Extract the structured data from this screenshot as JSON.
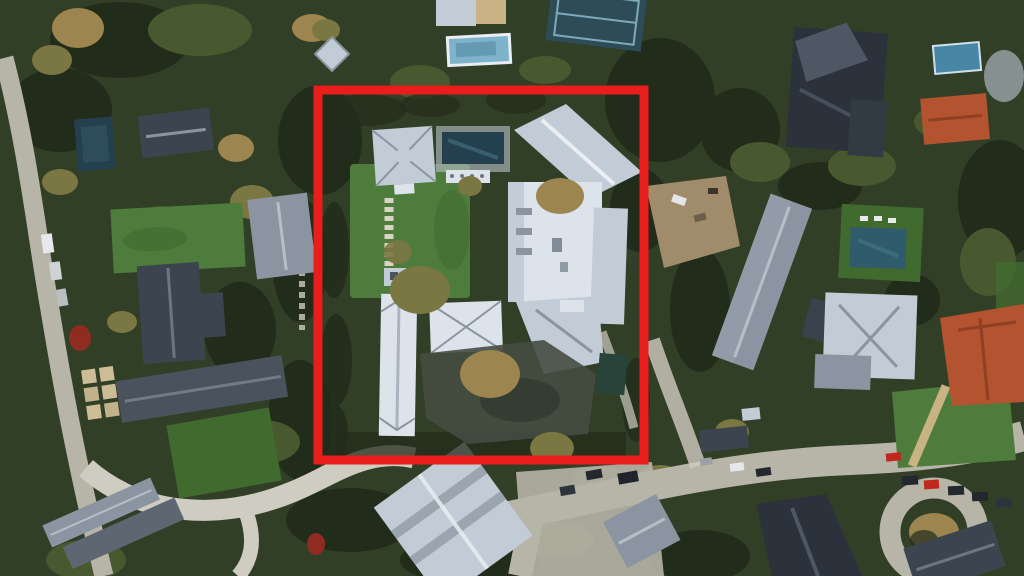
{
  "scene": {
    "type": "satellite-aerial-photo",
    "description": "Aerial satellite view of a wooded hillside residential neighborhood of large estates; one central walled estate with a white mansion, green lawn and swimming pool is outlined with a thick red rectangle.",
    "width": 1024,
    "height": 576
  },
  "highlight": {
    "label": "highlighted-estate-boundary",
    "x": 318,
    "y": 90,
    "width": 326,
    "height": 370,
    "stroke": "#e91d1b",
    "stroke_width": 9
  },
  "landmarks": [
    "highlighted estate: white mansion complex, guest lodge, lap pool, large lawn with specimen trees",
    "west neighbor estate: dark-roof house, long hall, lawns, oval driveway loop",
    "north features: swimming pool, tennis court, white outbuilding",
    "east neighbors: construction dirt lot, long gabled house, pool with turf deck, gray mansion, terracotta-roof mansions",
    "south: curving street with parked cars, cul-de-sac circle, large tilted gabled house",
    "roads: narrow lane along west edge, residential street across the bottom"
  ],
  "palette": {
    "canopy": "#323f27",
    "canopy_dark": "#222c1b",
    "canopy_light": "#49592f",
    "lawn": "#4e7c3c",
    "lawn_dark": "#416a2f",
    "road": "#b7b4a8",
    "road_light": "#cfccc2",
    "roof_white": "#dde3ea",
    "roof_light": "#c2ccd6",
    "roof_mid": "#8b95a1",
    "roof_dark": "#3c454f",
    "roof_darker": "#2b323b",
    "roof_terracotta": "#b4532f",
    "roof_terracotta_dark": "#8e3f24",
    "pool_dark": "#24404e",
    "pool_teal": "#2f5b6d",
    "pool_blue": "#7fb3cc",
    "tennis_court": "#2e4c58",
    "tree_olive": "#7b7742",
    "tree_tan": "#9c854e",
    "dirt": "#a08c6a",
    "hedge_dark": "#28443a",
    "shadow": "#1c2418",
    "car_red": "#c0281e",
    "car_dark": "#23282e",
    "car_white": "#e6e8ea"
  }
}
